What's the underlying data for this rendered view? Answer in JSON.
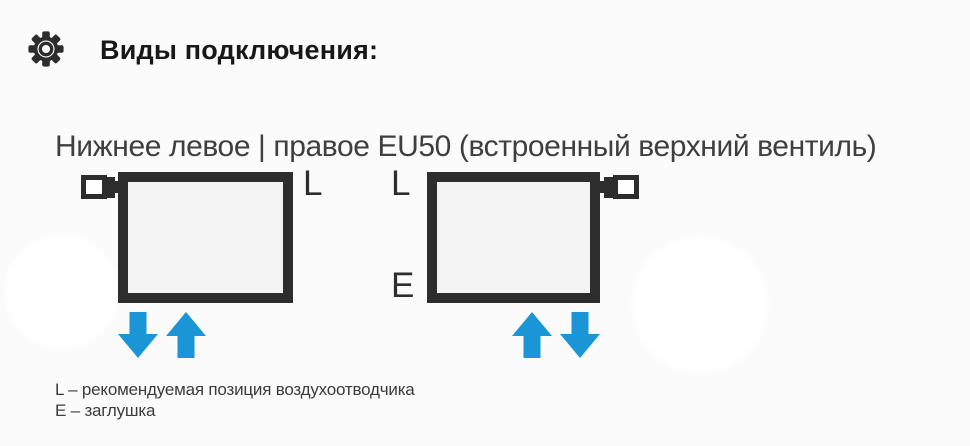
{
  "header": {
    "title": "Виды подключения:"
  },
  "section": {
    "subtitle": "Нижнее левое | правое EU50 (встроенный верхний вентиль)"
  },
  "diagram": {
    "left_radiator": {
      "vent_label": "L",
      "valve_position": "top-left",
      "flow_arrows": [
        "down",
        "up"
      ]
    },
    "right_radiator": {
      "vent_label": "L",
      "plug_label": "E",
      "valve_position": "top-right",
      "flow_arrows": [
        "up",
        "down"
      ]
    },
    "colors": {
      "outline": "#2d2d2d",
      "radiator_fill": "#f3f3f3",
      "arrow_blue": "#1a96d6"
    }
  },
  "legend": {
    "line1": "L – рекомендуемая позиция воздухоотводчика",
    "line2": "E – заглушка"
  }
}
